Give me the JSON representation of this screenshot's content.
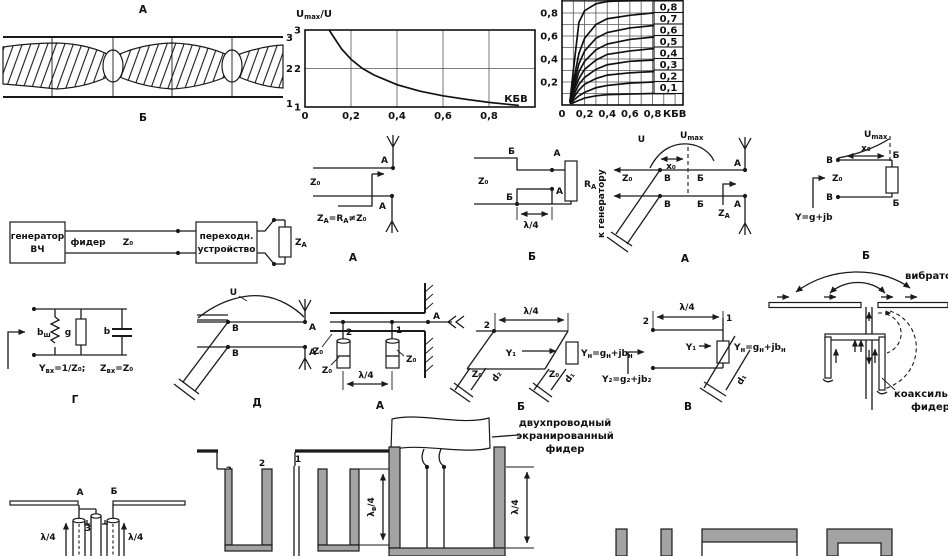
{
  "standing_wave": {
    "top_label": "А",
    "bottom_label": "Б",
    "line_labels": [
      "3",
      "2",
      "1"
    ]
  },
  "chart_data": [
    {
      "type": "line",
      "title": "Umax/U",
      "title_parts": [
        "U",
        "max",
        "/U"
      ],
      "xlabel": "КБВ",
      "xlim": [
        0,
        1.0
      ],
      "ylim": [
        1,
        3
      ],
      "xticks": [
        0,
        0.2,
        0.4,
        0.6,
        0.8
      ],
      "xtick_labels": [
        "0",
        "0,2",
        "0,4",
        "0,6",
        "0,8"
      ],
      "yticks": [
        1,
        2,
        3
      ],
      "ytick_labels": [
        "1",
        "2",
        "3"
      ],
      "grid_x": [
        0.2,
        0.4,
        0.6,
        0.8
      ],
      "grid_y": [
        2
      ],
      "legend": "none",
      "series": [
        {
          "name": "Umax/U",
          "x": [
            0.105,
            0.13,
            0.16,
            0.2,
            0.25,
            0.3,
            0.4,
            0.5,
            0.6,
            0.7,
            0.8,
            0.93
          ],
          "y": [
            3.05,
            2.77,
            2.5,
            2.24,
            2.0,
            1.83,
            1.58,
            1.41,
            1.29,
            1.2,
            1.12,
            1.04
          ]
        }
      ]
    },
    {
      "type": "line",
      "title": "",
      "xlabel": "КБВ",
      "xlim": [
        0,
        1.07
      ],
      "ylim": [
        0,
        0.913
      ],
      "xticks": [
        0,
        0.2,
        0.4,
        0.6,
        0.8
      ],
      "xtick_labels": [
        "0",
        "0,2",
        "0,4",
        "0,6",
        "0,8"
      ],
      "yticks": [
        0.2,
        0.4,
        0.6,
        0.8
      ],
      "ytick_labels": [
        "0,2",
        "0,4",
        "0,6",
        "0,8"
      ],
      "grid_x": [
        0.1,
        0.2,
        0.3,
        0.4,
        0.5,
        0.6,
        0.7,
        0.8,
        0.9,
        1.0
      ],
      "grid_y": [
        0.1,
        0.2,
        0.3,
        0.4,
        0.5,
        0.6,
        0.7,
        0.8,
        0.9
      ],
      "legend": "boxed labels at right edge",
      "series": [
        {
          "name": "0,9",
          "asymptote": 0.9,
          "x": [
            0.07,
            0.1,
            0.15,
            0.2,
            0.3,
            0.4,
            0.6,
            0.8,
            1.0
          ],
          "y": [
            0.03,
            0.3,
            0.72,
            0.82,
            0.88,
            0.9,
            0.91,
            0.92,
            0.92
          ]
        },
        {
          "name": "0,8",
          "label": "0,8",
          "asymptote": 0.8,
          "x": [
            0.07,
            0.1,
            0.15,
            0.2,
            0.3,
            0.4,
            0.6,
            0.8,
            1.0
          ],
          "y": [
            0.03,
            0.2,
            0.45,
            0.58,
            0.7,
            0.75,
            0.78,
            0.8,
            0.8
          ]
        },
        {
          "name": "0,7",
          "label": "0,7",
          "asymptote": 0.7,
          "x": [
            0.07,
            0.1,
            0.15,
            0.2,
            0.3,
            0.4,
            0.6,
            0.8,
            1.0
          ],
          "y": [
            0.03,
            0.16,
            0.36,
            0.47,
            0.58,
            0.63,
            0.67,
            0.69,
            0.7
          ]
        },
        {
          "name": "0,6",
          "label": "0,6",
          "asymptote": 0.6,
          "x": [
            0.07,
            0.1,
            0.15,
            0.2,
            0.3,
            0.4,
            0.6,
            0.8,
            1.0
          ],
          "y": [
            0.02,
            0.13,
            0.29,
            0.38,
            0.48,
            0.53,
            0.57,
            0.59,
            0.6
          ]
        },
        {
          "name": "0,5",
          "label": "0,5",
          "asymptote": 0.5,
          "x": [
            0.07,
            0.1,
            0.15,
            0.2,
            0.3,
            0.4,
            0.6,
            0.8,
            1.0
          ],
          "y": [
            0.02,
            0.11,
            0.23,
            0.31,
            0.39,
            0.44,
            0.47,
            0.49,
            0.5
          ]
        },
        {
          "name": "0,4",
          "label": "0,4",
          "asymptote": 0.4,
          "x": [
            0.07,
            0.1,
            0.15,
            0.2,
            0.3,
            0.4,
            0.6,
            0.8,
            1.0
          ],
          "y": [
            0.02,
            0.08,
            0.18,
            0.24,
            0.31,
            0.35,
            0.38,
            0.39,
            0.4
          ]
        },
        {
          "name": "0,3",
          "label": "0,3",
          "asymptote": 0.3,
          "x": [
            0.07,
            0.1,
            0.15,
            0.2,
            0.3,
            0.4,
            0.6,
            0.8,
            1.0
          ],
          "y": [
            0.02,
            0.06,
            0.13,
            0.18,
            0.23,
            0.26,
            0.28,
            0.29,
            0.3
          ]
        },
        {
          "name": "0,2",
          "label": "0,2",
          "asymptote": 0.2,
          "x": [
            0.07,
            0.1,
            0.15,
            0.2,
            0.3,
            0.4,
            0.6,
            0.8,
            1.0
          ],
          "y": [
            0.01,
            0.04,
            0.08,
            0.11,
            0.15,
            0.17,
            0.19,
            0.2,
            0.2
          ]
        },
        {
          "name": "0,1",
          "label": "0,1",
          "asymptote": 0.1,
          "x": [
            0.07,
            0.1,
            0.15,
            0.2,
            0.3,
            0.4,
            0.6,
            0.8,
            1.0
          ],
          "y": [
            0.01,
            0.02,
            0.04,
            0.06,
            0.08,
            0.09,
            0.095,
            0.1,
            0.1
          ]
        }
      ]
    }
  ],
  "block_diagram": {
    "generator_line1": "генератор",
    "generator_line2": "ВЧ",
    "feeder_label": "фидер",
    "z0": "Z₀",
    "device_line1": "переходн.",
    "device_line2": "устройство",
    "za_parts": [
      "Z",
      "А"
    ]
  },
  "to_generator": "к генератору",
  "diag_direct": {
    "z0": "Z₀",
    "a_top": "А",
    "a_bottom": "А",
    "equation_parts": [
      "Z",
      "А",
      "=R",
      "А",
      "≠Z₀"
    ],
    "caption": "А"
  },
  "diag_quarter": {
    "z0": "Z₀",
    "b_top": "Б",
    "a_top": "А",
    "b_bottom": "Б",
    "a_bottom": "А",
    "ra_parts": [
      "R",
      "А"
    ],
    "lambda": "λ/4",
    "caption": "Б"
  },
  "diag_xnode": {
    "u": "U",
    "umax_parts": [
      "U",
      "max"
    ],
    "x0": "x₀",
    "z0": "Z₀",
    "v1": "В",
    "b1": "Б",
    "a1": "А",
    "v2": "В",
    "b2": "Б",
    "a2": "А",
    "za_parts": [
      "Z",
      "А"
    ],
    "caption": "А"
  },
  "diag_reactive": {
    "umax_parts": [
      "U",
      "max"
    ],
    "x0": "x₀",
    "v1": "В",
    "v2": "В",
    "b1": "Б",
    "b2": "Б",
    "z0": "Z₀",
    "y": "Y=g+jb",
    "caption": "Б"
  },
  "diag_equiv": {
    "bsh_parts": [
      "b",
      "ш"
    ],
    "g": "g",
    "b": "b",
    "yin_parts": [
      "Y",
      "вх",
      "=1/Z₀;"
    ],
    "zin_parts": [
      "Z",
      "вх",
      "=Z₀"
    ],
    "caption": "Г"
  },
  "diag_d": {
    "u": "U",
    "v1": "В",
    "v2": "В",
    "a1": "А",
    "a2": "А",
    "caption": "Д"
  },
  "diag_plungers": {
    "n2": "2",
    "n1": "1",
    "a": "А",
    "z0_line": "Z₀",
    "z0_stub1": "Z₀",
    "z0_stub2": "Z₀",
    "lambda": "λ/4",
    "caption": "А"
  },
  "diag_parallelogram": {
    "lambda": "λ/4",
    "n2": "2",
    "y1": "Y₁",
    "yn_parts": [
      "Y",
      "н",
      "=g",
      "н",
      "+jb",
      "н"
    ],
    "z0_left": "Z₀",
    "d_left": "d₂",
    "z0_right": "Z₀",
    "d_right": "d₁",
    "caption": "Б"
  },
  "diag_v": {
    "lambda": "λ/4",
    "n2": "2",
    "n1": "1",
    "y1": "Y₁",
    "yn_parts": [
      "Y",
      "н",
      "=g",
      "н",
      "+jb",
      "н"
    ],
    "y2": "Y₂=g₂+jb₂",
    "d1": "d₁",
    "caption": "В"
  },
  "diag_vibrator": {
    "vibrator": "вибратор",
    "feeder_line1": "коаксильный",
    "feeder_line2": "фидер"
  },
  "diag_balun": {
    "a": "А",
    "b": "Б",
    "n3": "3",
    "lambda_left": "λ/4",
    "lambda_right": "λ/4"
  },
  "diag_channels": {
    "n3": "3",
    "n2": "2",
    "n1": "1",
    "lambda_parts": [
      "λ",
      "в",
      "/4"
    ]
  },
  "diag_shielded": {
    "label_line1": "двухпроводный",
    "label_line2": "экранированный",
    "label_line3": "фидер",
    "lambda": "λ/4"
  },
  "colors": {
    "ink": "#1a1a1a",
    "shield_gray": "#a3a3a3",
    "background": "#ffffff"
  }
}
